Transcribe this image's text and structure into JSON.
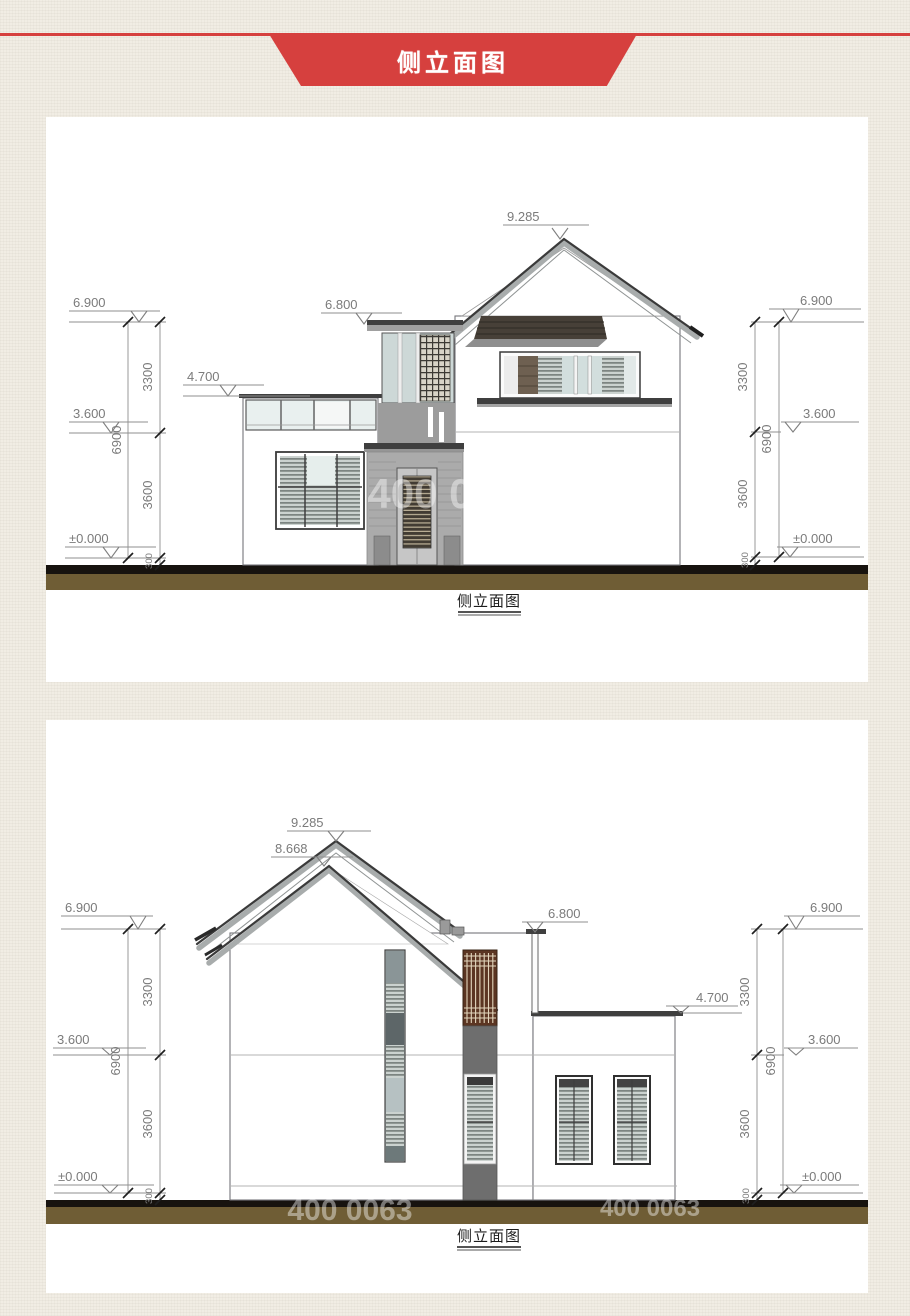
{
  "banner": {
    "title": "侧立面图"
  },
  "watermark": {
    "text": "400 0063"
  },
  "d1": {
    "caption": "侧立面图",
    "lv_ridge": "9.285",
    "lv_eave_l": "6.900",
    "lv_eave_r": "6.900",
    "lv_tower": "6.800",
    "lv_porch": "4.700",
    "lv_f2_l": "3.600",
    "lv_f2_r": "3.600",
    "lv_gnd_l": "±0.000",
    "lv_gnd_r": "±0.000",
    "dim_upper_l": "3300",
    "dim_lower_l": "3600",
    "dim_total_l": "6900",
    "dim_plinth_l": "300",
    "dim_upper_r": "3300",
    "dim_lower_r": "3600",
    "dim_total_r": "6900",
    "dim_plinth_r": "300"
  },
  "d2": {
    "caption": "侧立面图",
    "lv_ridge": "9.285",
    "lv_ridge2": "8.668",
    "lv_eave_l": "6.900",
    "lv_eave_r": "6.900",
    "lv_parapet": "6.800",
    "lv_wing": "4.700",
    "lv_f2_l": "3.600",
    "lv_f2_r": "3.600",
    "lv_gnd_l": "±0.000",
    "lv_gnd_r": "±0.000",
    "dim_upper_l": "3300",
    "dim_lower_l": "3600",
    "dim_total_l": "6900",
    "dim_plinth_l": "300",
    "dim_upper_r": "3300",
    "dim_lower_r": "3600",
    "dim_total_r": "6900",
    "dim_plinth_r": "300"
  }
}
